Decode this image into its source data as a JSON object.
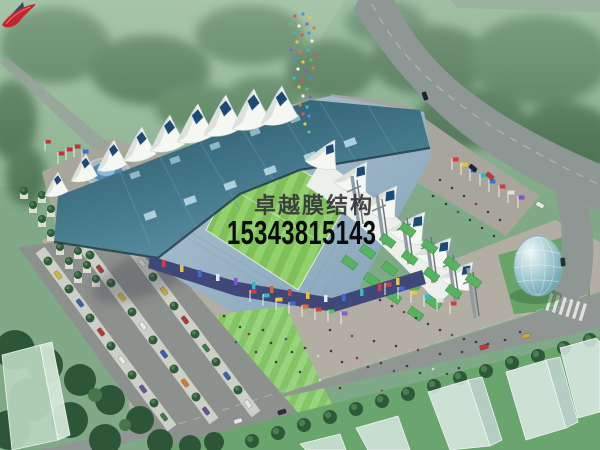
{
  "image_type": "aerial-architectural-rendering",
  "watermark": {
    "logo": "red-swoosh-logo",
    "company_name": "卓越膜结构",
    "phone_number": "15343815143"
  },
  "scene": {
    "landmarks": [
      "membrane-roof-stadium",
      "white-tensile-tent-roofline",
      "steel-mast-colonnade",
      "striped-football-pitch",
      "circular-fountain-plaza",
      "glass-egg-pavilion",
      "tree-lined-parking-avenue",
      "perimeter-roads",
      "crosswalk",
      "flag-rows",
      "ghost-buildings",
      "green-parkland"
    ]
  },
  "colors": {
    "logo_red": "#c5262c",
    "company_text": "#2b2b32",
    "phone_text": "#0b0b0d",
    "stadium_roof_teal": "#3b6c7e",
    "membrane_white": "#f5f7f2",
    "pitch_green": "#82c55e",
    "seating_blue": "#9db6c6",
    "tree_green": "#3f6b4a",
    "plaza_gray": "#b1ada3",
    "road_gray": "#8f9794",
    "fountain_blue": "#5588b5",
    "glass_egg_teal": "#9cc7cd"
  }
}
